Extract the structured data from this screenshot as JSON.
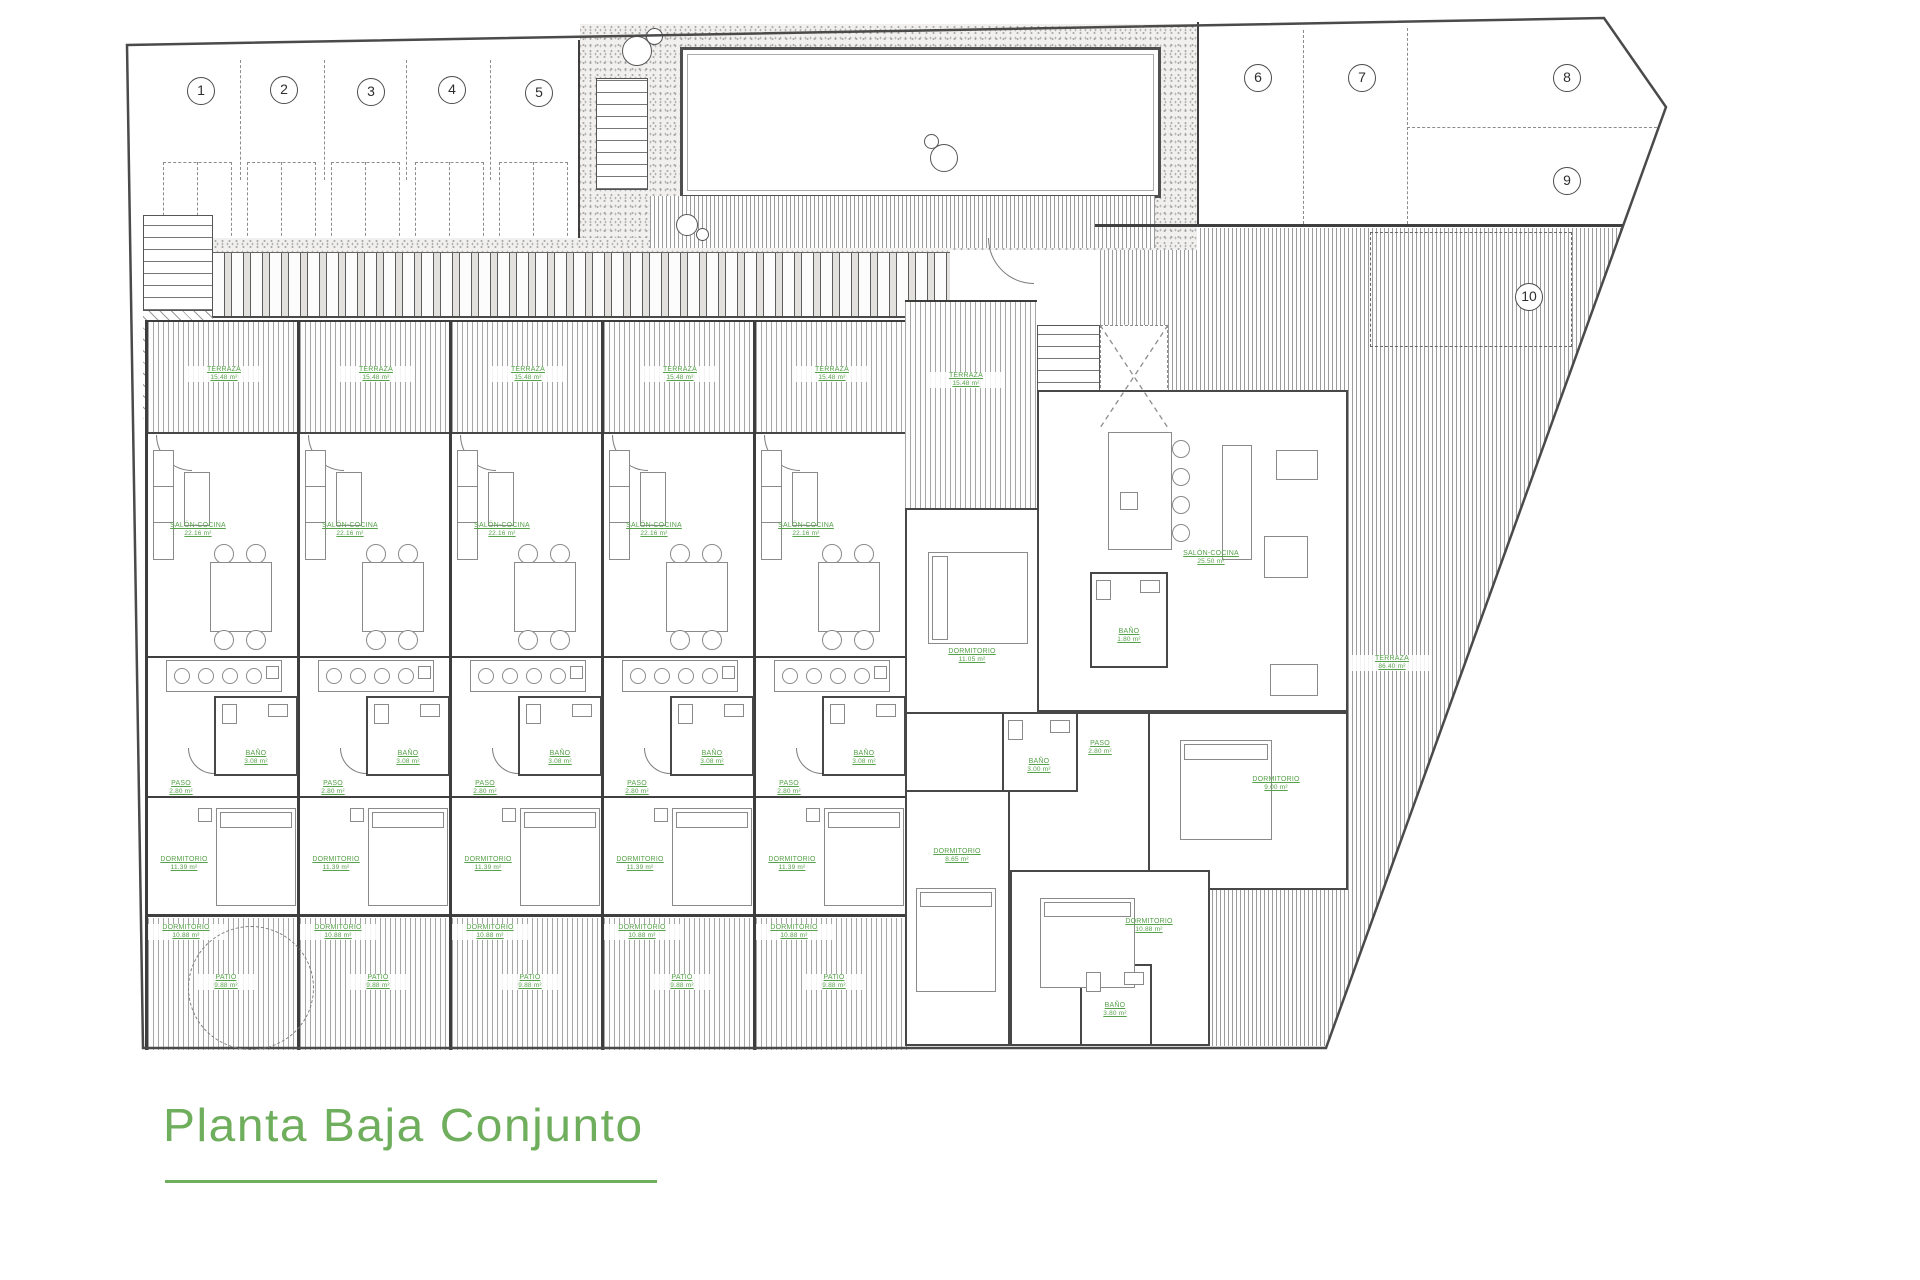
{
  "title": {
    "text": "Planta Baja Conjunto"
  },
  "colors": {
    "label_green": "#56a24a",
    "title_green": "#6fae5c",
    "line_gray": "#4a4a4a"
  },
  "parking_spaces": [
    "1",
    "2",
    "3",
    "4",
    "5",
    "6",
    "7",
    "8",
    "9",
    "10"
  ],
  "row_unit": {
    "terraza": {
      "name": "TERRAZA",
      "area": "15.48 m²"
    },
    "salon": {
      "name": "SALÓN-COCINA",
      "area": "22.16 m²"
    },
    "bano": {
      "name": "BAÑO",
      "area": "3.08 m²"
    },
    "paso": {
      "name": "PASO",
      "area": "2.80 m²"
    },
    "dorm1": {
      "name": "DORMITORIO",
      "area": "11.39 m²"
    },
    "dorm2": {
      "name": "DORMITORIO",
      "area": "10.88 m²"
    },
    "patio": {
      "name": "PATIO",
      "area": "9.88 m²"
    }
  },
  "corner_unit": {
    "terraza_entry": {
      "name": "TERRAZA",
      "area": "15.48 m²"
    },
    "salon": {
      "name": "SALÓN-COCINA",
      "area": "25.50 m²"
    },
    "dorm_oeste": {
      "name": "DORMITORIO",
      "area": "11.05 m²"
    },
    "bano_entrada": {
      "name": "BAÑO",
      "area": "1.80 m²"
    },
    "bano_centro": {
      "name": "BAÑO",
      "area": "3.00 m²"
    },
    "paso": {
      "name": "PASO",
      "area": "2.80 m²"
    },
    "dorm_este": {
      "name": "DORMITORIO",
      "area": "9.00 m²"
    },
    "dorm_suroeste": {
      "name": "DORMITORIO",
      "area": "8.65 m²"
    },
    "dorm_sur": {
      "name": "DORMITORIO",
      "area": "10.88 m²"
    },
    "bano_sur": {
      "name": "BAÑO",
      "area": "3.80 m²"
    },
    "terraza_grande": {
      "name": "TERRAZA",
      "area": "86.40 m²"
    }
  }
}
